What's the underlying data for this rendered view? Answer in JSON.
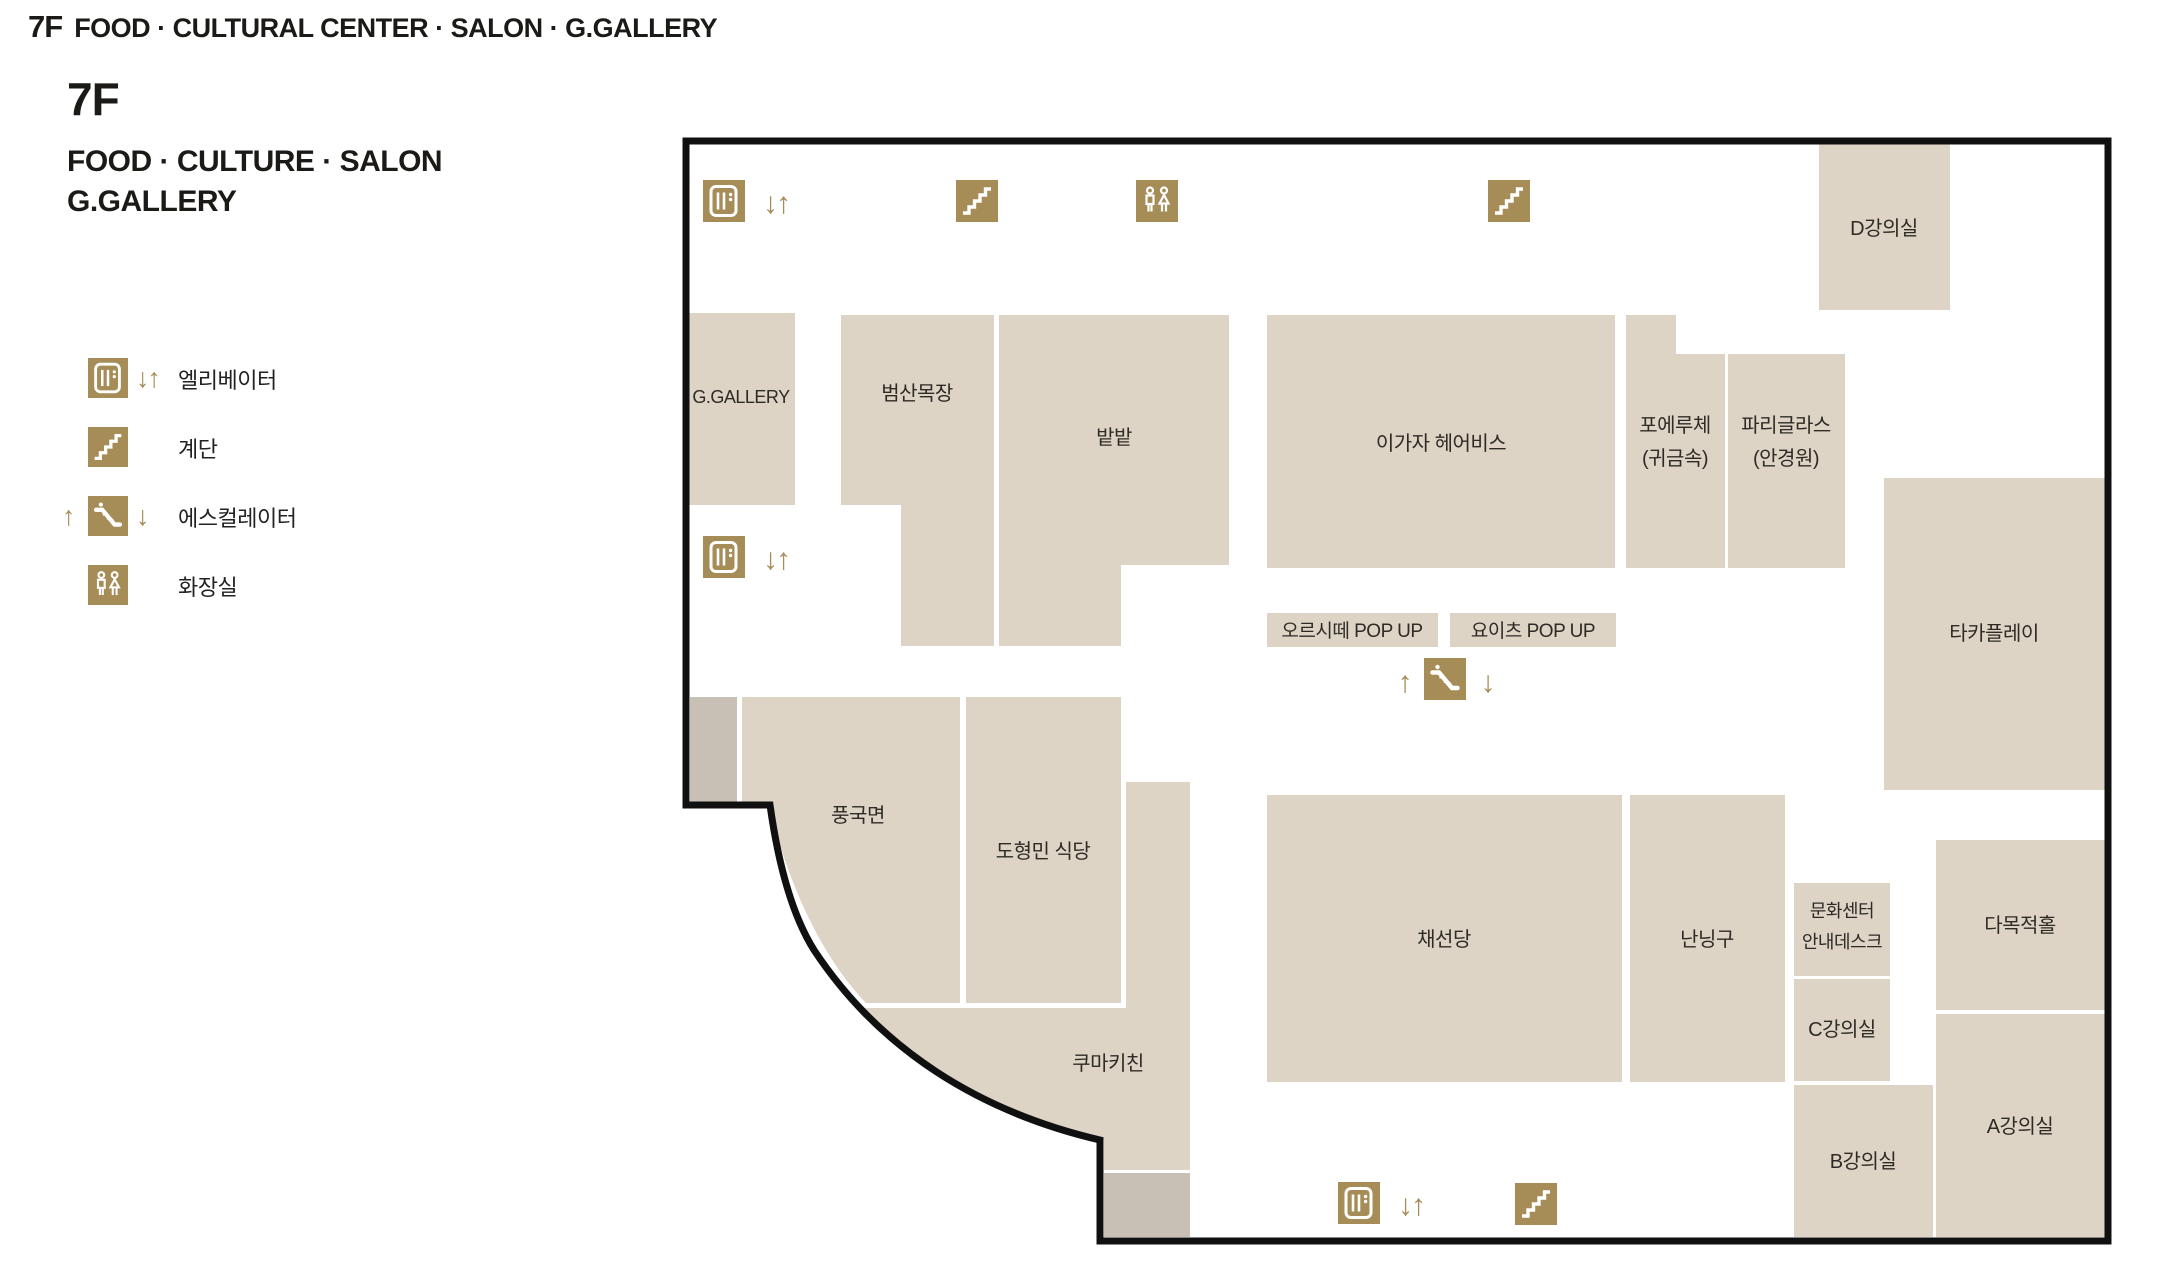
{
  "header": {
    "floor": "7F",
    "categories": "FOOD · CULTURAL CENTER · SALON · G.GALLERY"
  },
  "title": {
    "floor": "7F",
    "line1": "FOOD · CULTURE · SALON",
    "line2": "G.GALLERY"
  },
  "legend": {
    "items": [
      {
        "icon": "elevator-icon",
        "label": "엘리베이터"
      },
      {
        "icon": "stairs-icon",
        "label": "계단"
      },
      {
        "icon": "escalator-icon",
        "label": "에스컬레이터"
      },
      {
        "icon": "restroom-icon",
        "label": "화장실"
      }
    ]
  },
  "arrows": {
    "down_up": "↓↑",
    "up": "↑",
    "down": "↓"
  },
  "colors": {
    "room_fill": "#ddd4c6",
    "service_block_fill": "#c8c0b5",
    "icon_gold": "#a68c57",
    "outline": "#101010",
    "label_text": "#2e2a25"
  },
  "map": {
    "rooms": [
      {
        "id": "d-lecture-room",
        "name": "D강의실"
      },
      {
        "id": "g-gallery",
        "name": "G.GALLERY"
      },
      {
        "id": "beomsan-mokjang",
        "name": "범산목장"
      },
      {
        "id": "batbat",
        "name": "밭밭"
      },
      {
        "id": "igaja-hairbis",
        "name": "이가자 헤어비스"
      },
      {
        "id": "poeruche",
        "name": "포에루체 (귀금속)",
        "line1": "포에루체",
        "line2": "(귀금속)"
      },
      {
        "id": "pari-glass",
        "name": "파리글라스 (안경원)",
        "line1": "파리글라스",
        "line2": "(안경원)"
      },
      {
        "id": "taka-play",
        "name": "타카플레이"
      },
      {
        "id": "orsitte-popup",
        "name": "오르시떼 POP UP"
      },
      {
        "id": "yoits-popup",
        "name": "요이츠 POP UP"
      },
      {
        "id": "punggukmyeon",
        "name": "풍국면"
      },
      {
        "id": "dohyungmin-restaurant",
        "name": "도형민 식당"
      },
      {
        "id": "kuma-kitchen",
        "name": "쿠마키친"
      },
      {
        "id": "chaesundang",
        "name": "채선당"
      },
      {
        "id": "nanningoo",
        "name": "난닝구"
      },
      {
        "id": "culture-center-desk",
        "name": "문화센터 안내데스크",
        "line1": "문화센터",
        "line2": "안내데스크"
      },
      {
        "id": "c-lecture-room",
        "name": "C강의실"
      },
      {
        "id": "multi-purpose-hall",
        "name": "다목적홀"
      },
      {
        "id": "b-lecture-room",
        "name": "B강의실"
      },
      {
        "id": "a-lecture-room",
        "name": "A강의실"
      }
    ]
  }
}
